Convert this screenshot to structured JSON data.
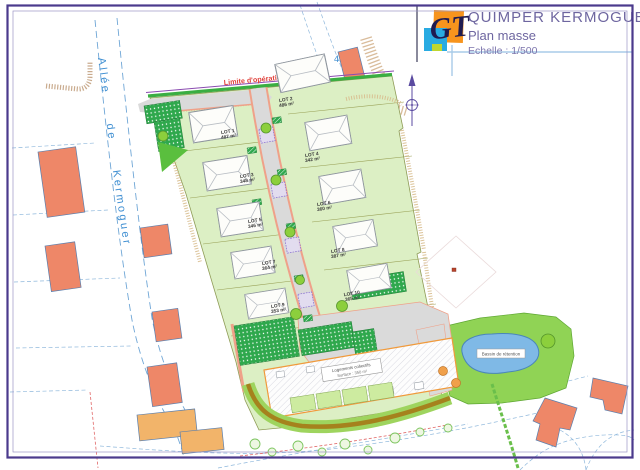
{
  "title_block": {
    "project": "QUIMPER KERMOGUER",
    "drawing": "Plan masse",
    "scale": "Echelle : 1/500",
    "logo": "GT"
  },
  "map": {
    "street_label": "Allée de Kermoguer",
    "operation_limit_label": "Limite d'opération",
    "parcel_number": "452",
    "pond_label": "Bassin de rétention",
    "collective_label_line1": "Logements collectifs",
    "collective_label_line2": "Surface : 350 m²"
  },
  "lots": [
    {
      "name": "LOT 1",
      "area": "487 m²"
    },
    {
      "name": "LOT 2",
      "area": "486 m²"
    },
    {
      "name": "LOT 3",
      "area": "348 m²"
    },
    {
      "name": "LOT 4",
      "area": "342 m²"
    },
    {
      "name": "LOT 5",
      "area": "346 m²"
    },
    {
      "name": "LOT 6",
      "area": "360 m²"
    },
    {
      "name": "LOT 7",
      "area": "364 m²"
    },
    {
      "name": "LOT 8",
      "area": "387 m²"
    },
    {
      "name": "LOT 9",
      "area": "353 m²"
    },
    {
      "name": "LOT 10",
      "area": "365 m²"
    }
  ],
  "colors": {
    "page_border": "#4b3a8c",
    "title_text": "#6e66a0",
    "logo_orange": "#f7941d",
    "logo_cyan": "#29abe2",
    "site_green": "#dcefc4",
    "hedge_green": "#3aae42",
    "parking_green": "#2fa84d",
    "lawn_green": "#9ed45e",
    "road_gray": "#dadada",
    "sidewalk_salmon": "#efa189",
    "existing_building_salmon": "#ee8768",
    "existing_building_orange": "#f2b46a",
    "water_blue": "#7fb9e6",
    "path_brown": "#a5821d",
    "limit_red": "#e0403a",
    "street_label_blue": "#3f8fd2"
  }
}
